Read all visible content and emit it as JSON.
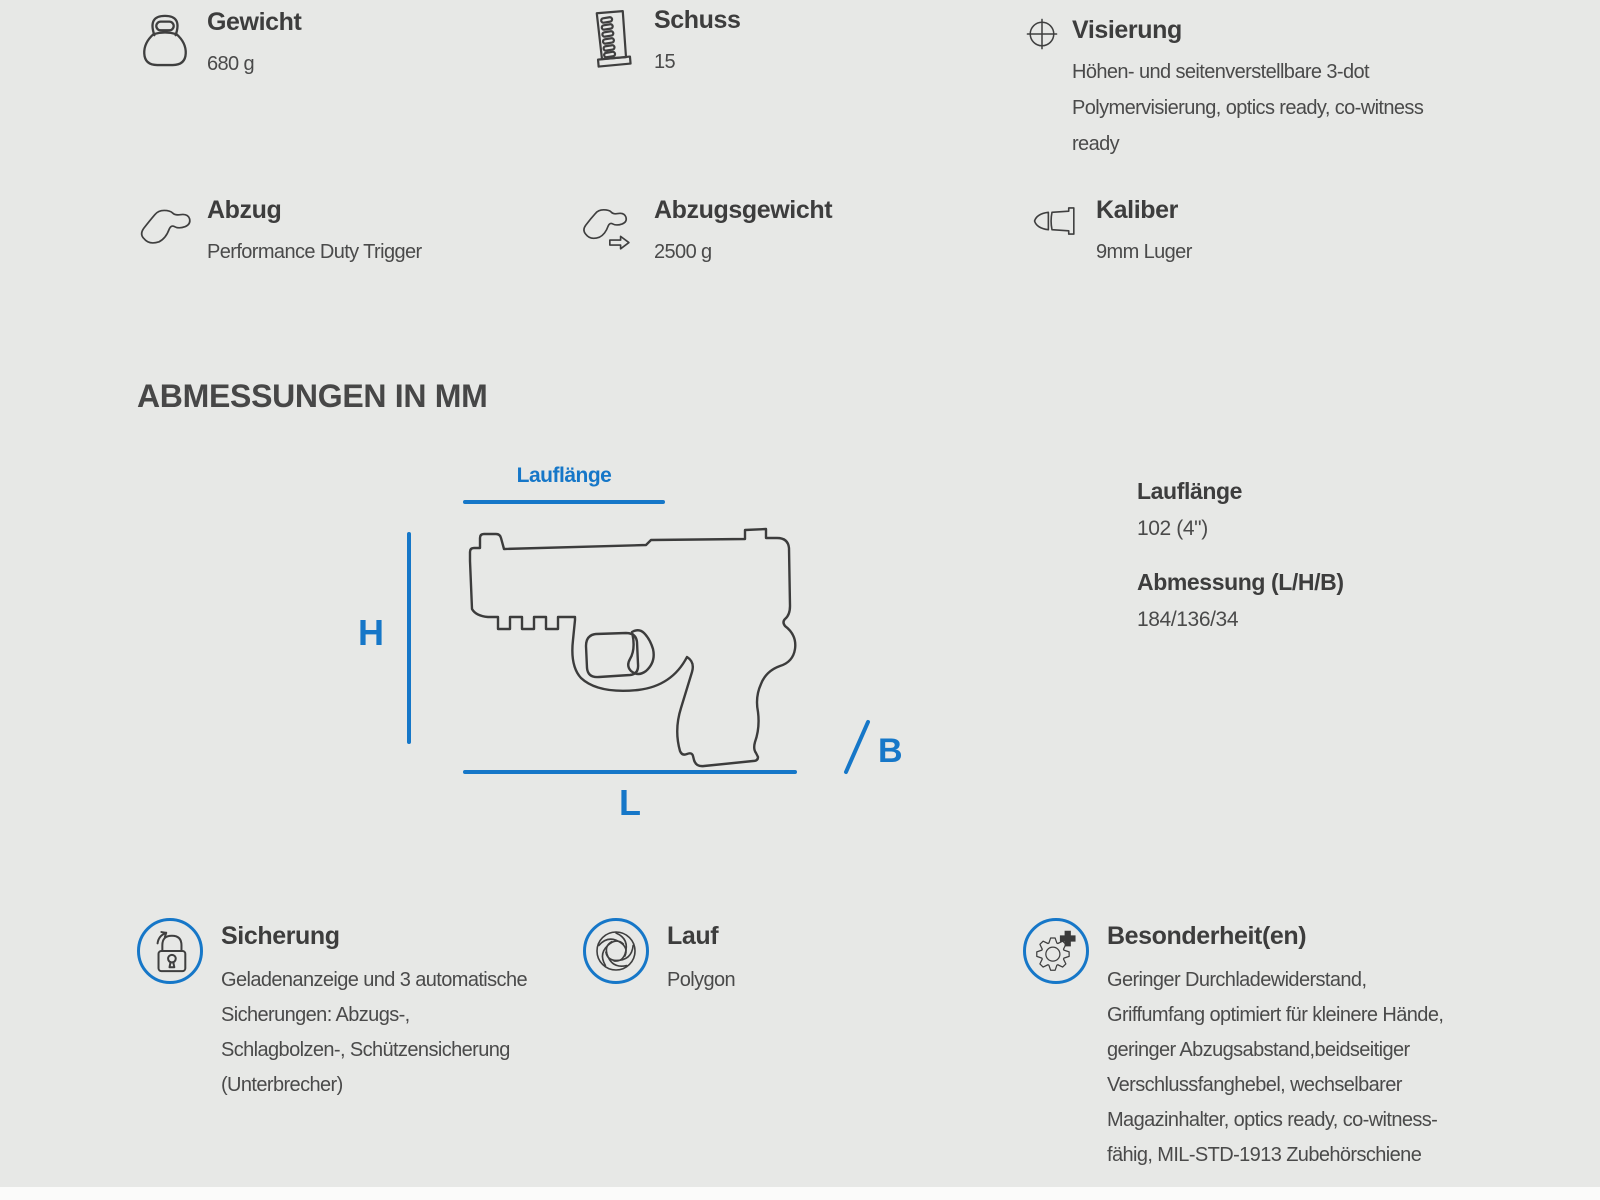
{
  "page": {
    "accent_color": "#1677c8",
    "background_color": "#e7e8e6",
    "text_color": "#3d3d3d"
  },
  "specs": [
    {
      "icon": "kettlebell-icon",
      "label": "Gewicht",
      "value": "680 g"
    },
    {
      "icon": "magazine-icon",
      "label": "Schuss",
      "value": "15"
    },
    {
      "icon": "crosshair-icon",
      "label": "Visierung",
      "value": "Höhen- und seitenverstellbare 3-dot Polymervisierung, optics ready, co-witness ready"
    },
    {
      "icon": "trigger-icon",
      "label": "Abzug",
      "value": "Performance Duty Trigger"
    },
    {
      "icon": "trigger-weight-icon",
      "label": "Abzugsgewicht",
      "value": "2500 g"
    },
    {
      "icon": "bullet-icon",
      "label": "Kaliber",
      "value": "9mm Luger"
    }
  ],
  "dimensions": {
    "heading": "ABMESSUNGEN IN MM",
    "diagram_labels": {
      "barrel": "Lauflänge",
      "height": "H",
      "length": "L",
      "width": "B"
    },
    "details": [
      {
        "label": "Lauflänge",
        "value": "102 (4\")"
      },
      {
        "label": "Abmessung (L/H/B)",
        "value": "184/136/34"
      }
    ]
  },
  "features": [
    {
      "icon": "lock-icon",
      "label": "Sicherung",
      "value": "Geladenanzeige und 3 automatische Sicherungen: Abzugs-, Schlagbolzen-, Schützensicherung (Unterbrecher)"
    },
    {
      "icon": "rifling-icon",
      "label": "Lauf",
      "value": "Polygon"
    },
    {
      "icon": "gear-plus-icon",
      "label": "Besonderheit(en)",
      "value": "Geringer Durchladewiderstand, Griffumfang optimiert für kleinere Hände, geringer Abzugsabstand,beidseitiger Verschlussfanghebel, wechselbarer Magazinhalter, optics ready, co-witness-fähig, MIL-STD-1913 Zubehörschiene"
    }
  ]
}
